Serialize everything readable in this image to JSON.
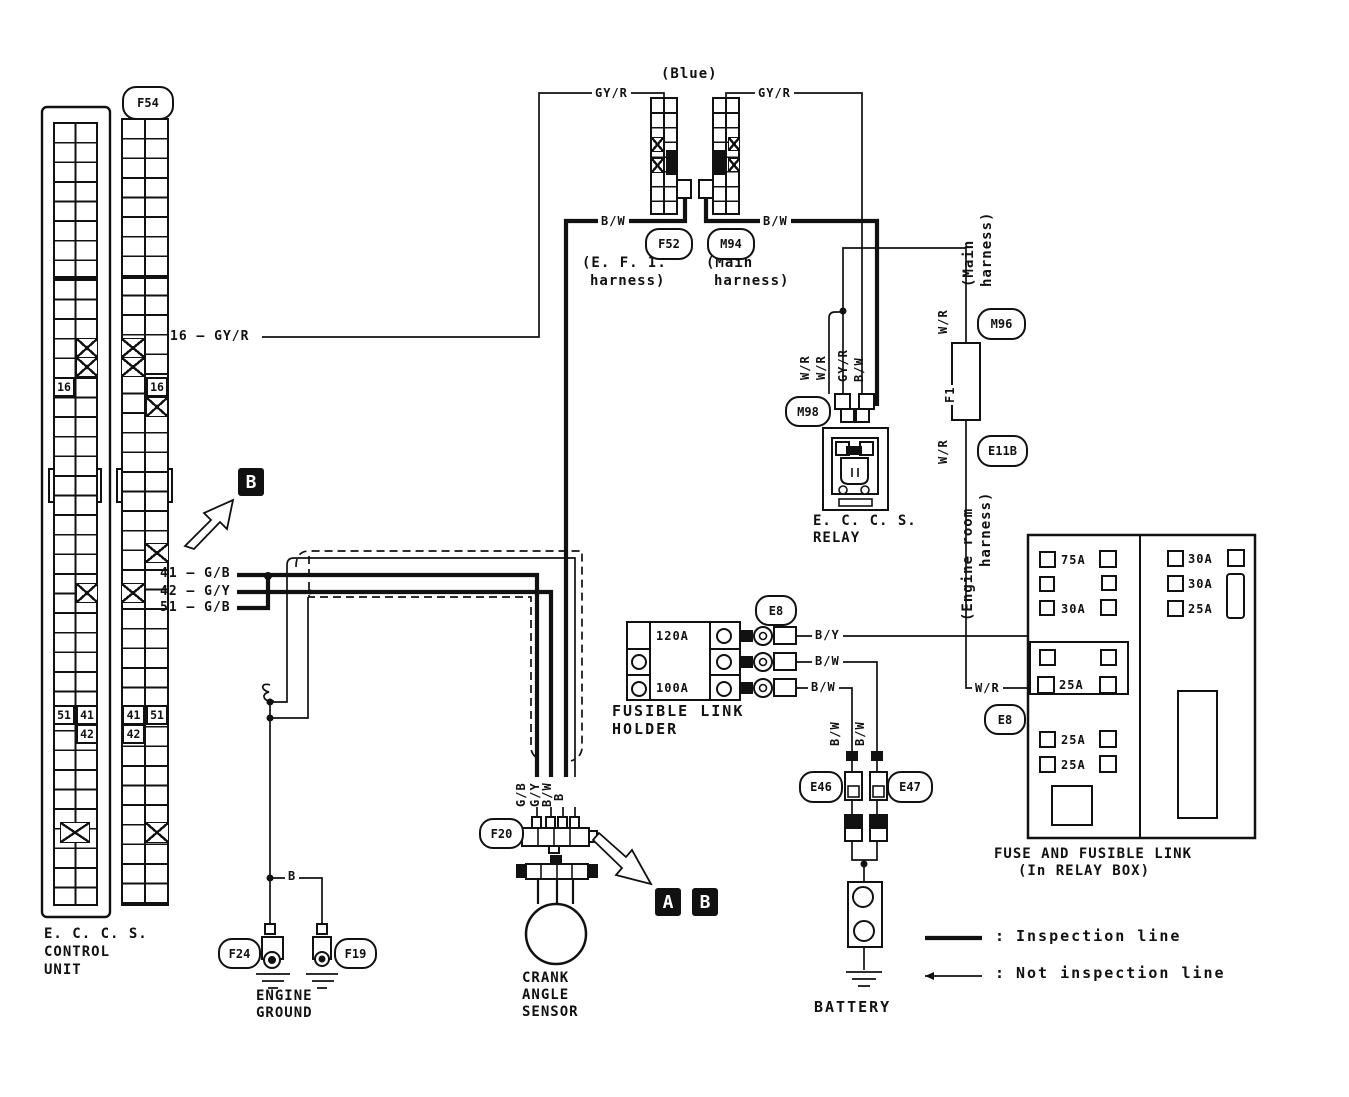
{
  "ecu": {
    "title": [
      "E. C. C. S.",
      "CONTROL",
      "UNIT"
    ],
    "connector_id": "F54",
    "pins": {
      "left16": "16",
      "right16": "16",
      "l51": "51",
      "l41": "41",
      "l42": "42",
      "r41": "41",
      "r51": "51",
      "r42": "42"
    }
  },
  "ecu_wires": {
    "w16": "16 — GY/R",
    "w41": "41 — G/B",
    "w42": "42 — G/Y",
    "w51": "51 — G/B"
  },
  "top": {
    "blue": "(Blue)",
    "gyr_left": "GY/R",
    "gyr_right": "GY/R",
    "bw_left": "B/W",
    "bw_right": "B/W",
    "f52": "F52",
    "m94": "M94",
    "efi_harness": [
      "(E. F. I.",
      "harness)"
    ],
    "main_harness": [
      "(Main",
      "harness)"
    ],
    "main_harness_vert": [
      "(Main",
      "harness)"
    ]
  },
  "relay": {
    "id": "M98",
    "title": [
      "E. C. C. S.",
      "RELAY"
    ],
    "wires": [
      "W/R",
      "W/R",
      "GY/R",
      "B/W"
    ]
  },
  "right": {
    "m96": "M96",
    "wr_top": "W/R",
    "f1": "F1",
    "wr_bottom": "W/R",
    "e11b": "E11B",
    "engine_room_harness": [
      "(Engine room",
      "harness)"
    ],
    "wr_fusebox": "W/R",
    "e8": "E8"
  },
  "fusible_link": {
    "id": "E8",
    "title": [
      "FUSIBLE LINK",
      "HOLDER"
    ],
    "a120": "120A",
    "a100": "100A",
    "out": [
      "B/Y",
      "B/W",
      "B/W"
    ]
  },
  "battery": {
    "label": "BATTERY",
    "e46": "E46",
    "e47": "E47",
    "w1": "B/W",
    "w2": "B/W"
  },
  "fusebox": {
    "title": [
      "FUSE AND FUSIBLE LINK",
      "(In RELAY BOX)"
    ],
    "left": [
      "75A",
      "30A",
      "25A",
      "25A",
      "25A"
    ],
    "right": [
      "30A",
      "30A",
      "25A"
    ]
  },
  "cas": {
    "id": "F20",
    "title": [
      "CRANK",
      "ANGLE",
      "SENSOR"
    ],
    "wires": [
      "G/B",
      "G/Y",
      "B/W",
      "B"
    ]
  },
  "ground": {
    "label": [
      "ENGINE",
      "GROUND"
    ],
    "f24": "F24",
    "f19": "F19",
    "b": "B"
  },
  "markers": {
    "a": "A",
    "b": "B",
    "b_top": "B"
  },
  "legend": {
    "colon1": ":",
    "colon2": ":",
    "inspection": "Inspection line",
    "not_inspection": "Not inspection line"
  }
}
